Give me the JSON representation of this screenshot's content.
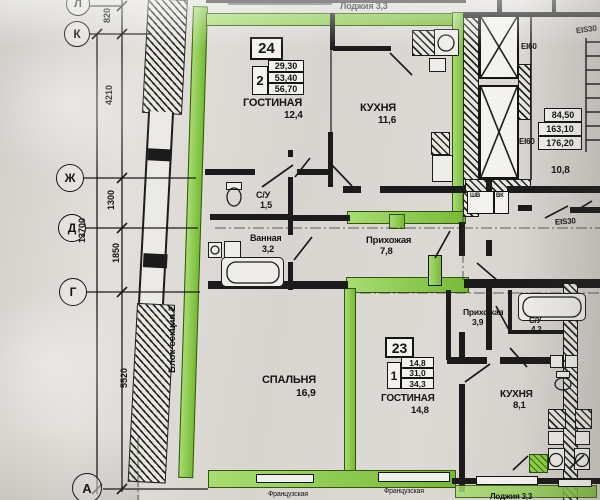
{
  "axes": {
    "l": "Л",
    "k": "К",
    "zh": "Ж",
    "d": "Д",
    "g": "Г",
    "a": "А"
  },
  "dims": {
    "v820": "820",
    "v4210": "4210",
    "v1300": "1300",
    "v13700": "13700",
    "v1850": "1850",
    "v5520": "5520"
  },
  "apartments": {
    "apt24": {
      "number": "24",
      "rooms": "2",
      "area_living": "29,30",
      "area_total": "53,40",
      "area_full": "56,70"
    },
    "apt23": {
      "number": "23",
      "rooms": "1",
      "area_living": "14,8",
      "area_total": "31,0",
      "area_full": "34,3"
    }
  },
  "rooms": {
    "loggia24": {
      "name": "Лоджия",
      "area": "3,3"
    },
    "living24": {
      "name": "ГОСТИНАЯ",
      "area": "12,4"
    },
    "kitchen24": {
      "name": "КУХНЯ",
      "area": "11,6"
    },
    "wc24": {
      "name": "С/У",
      "area": "1,5"
    },
    "bath24": {
      "name": "Ванная",
      "area": "3,2"
    },
    "hall24": {
      "name": "Прихожая",
      "area": "7,8"
    },
    "bedroom24": {
      "name": "СПАЛЬНЯ",
      "area": "16,9"
    },
    "living23": {
      "name": "ГОСТИНАЯ",
      "area": "14,8"
    },
    "kitchen23": {
      "name": "КУХНЯ",
      "area": "8,1"
    },
    "hall23": {
      "name": "Прихожая",
      "area": "3,9"
    },
    "wc23": {
      "name": "С/У",
      "area": "4,2"
    },
    "lobby": {
      "area": "10,8"
    },
    "loggia23": {
      "name": "Лоджия",
      "area": "3,3"
    }
  },
  "fire": {
    "ei60_a": "EI60",
    "ei60_b": "EI60",
    "eis30_top": "EIS30",
    "eis30_mid": "EIS30"
  },
  "stair_table": {
    "r1": "84,50",
    "r2": "163,10",
    "r3": "176,20"
  },
  "misc": {
    "shv": "ШВ",
    "vk": "ВК",
    "block_section": "Блок-секция 2",
    "french_a": "Французская",
    "french_b": "Французская"
  },
  "colors": {
    "highlight": "#85cf3c",
    "ink": "#1b1b1b",
    "paper": "#d8d5d0"
  }
}
